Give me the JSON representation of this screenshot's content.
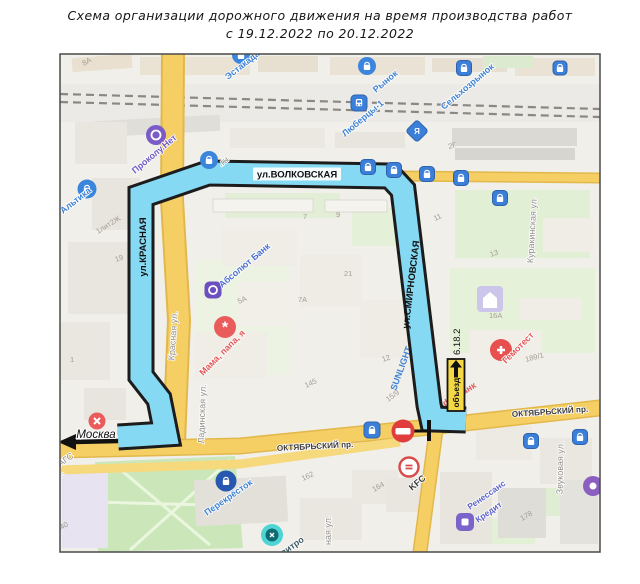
{
  "title": {
    "line1": "Схема организации дорожного движения на время производства работ",
    "line2": "с 19.12.2022 по 20.12.2022"
  },
  "route": {
    "volkovskaya": "ул.ВОЛКОВСКАЯ",
    "krasnaya": "ул.КРАСНАЯ",
    "smirnovskaya": "ул.СМИРНОВСКАЯ",
    "direction_moscow": "Москва",
    "detour_sign_code": "6.18.2",
    "detour_sign_text": "объезд"
  },
  "streets": {
    "oktyabrsky_left": "ОКТЯБРЬСКИЙ пр.",
    "oktyabrsky_right": "ОКТЯБРЬСКИЙ пр.",
    "krasnaya": "Красная ул.",
    "ladinskaya": "Ладинская ул.",
    "kurakinskaya": "Куракинская ул.",
    "zvukovaya": "Звуковая ул.",
    "naya": "ная ул.",
    "zags": "ЗАГС",
    "omu": "ому..."
  },
  "pois": {
    "estakada": "Эстакада",
    "rynok": "Рынок",
    "lyubertsy": "Люберцы-1",
    "selkhozrynok": "Сельхозрынок",
    "prokolu": "Проколу.Нет",
    "altika": "Альтика",
    "ru": ".ru",
    "absolut": "Абсолют Банк",
    "mama": "Мама, папа, я",
    "sunlight": "SUNLIGHT",
    "gemotest": "Гемотест",
    "alfabank": "Альфа-Банк",
    "kfc": "KFC",
    "renessans1": "Ренессанс",
    "renessans2": "Кредит",
    "perekrestok": "Перекрёсток",
    "vitro": "витро",
    "ya": "Я"
  },
  "buildings": {
    "b8a": "8А",
    "b2g": "2Г",
    "b11": "11",
    "b13": "13",
    "b7": "7",
    "b9": "9",
    "b21": "21",
    "b5a": "5А",
    "b7a": "7А",
    "b19": "19",
    "b1lit": "1лит2Ж",
    "b15_9": "15/9",
    "b189": "189/1",
    "b145": "145",
    "b162": "162",
    "b164": "164",
    "b178": "178",
    "b140": "140",
    "b12": "12",
    "b16a": "16А",
    "b1": "1"
  },
  "colors": {
    "route": "#86d9f3",
    "road_yellow": "#f5cf63",
    "poi_blue": "#3b7fd9",
    "poi_red": "#ea5c5c",
    "poi_purple": "#7a5bc7",
    "sign_yellow": "#f4d944",
    "closure_red": "#e03d3d"
  }
}
